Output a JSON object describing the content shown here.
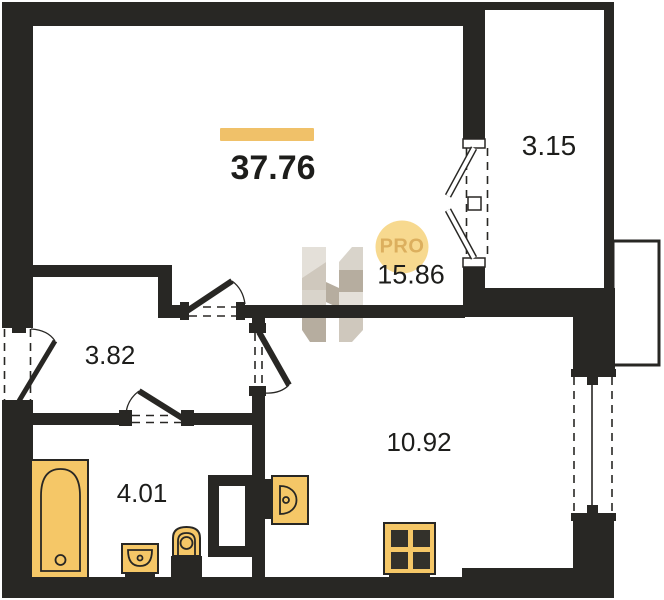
{
  "plan": {
    "total_area": "37.76",
    "badge_label": "PRO",
    "rooms": [
      {
        "name": "living-room",
        "area": "15.86"
      },
      {
        "name": "kitchen-living",
        "area": "10.92"
      },
      {
        "name": "hallway",
        "area": "3.82"
      },
      {
        "name": "bathroom",
        "area": "4.01"
      },
      {
        "name": "balcony",
        "area": "3.15"
      }
    ]
  },
  "colors": {
    "wall": "#282724",
    "label": "#1d1d1b",
    "fixture": "#f5c767",
    "accent_bar": "#f0c169",
    "badge_bg": "#f7d98f",
    "badge_text": "#dcaf5e",
    "watermark_light": "#e4e0d9",
    "watermark_mid": "#cfc8bd",
    "watermark_dark": "#b6ad9f"
  }
}
